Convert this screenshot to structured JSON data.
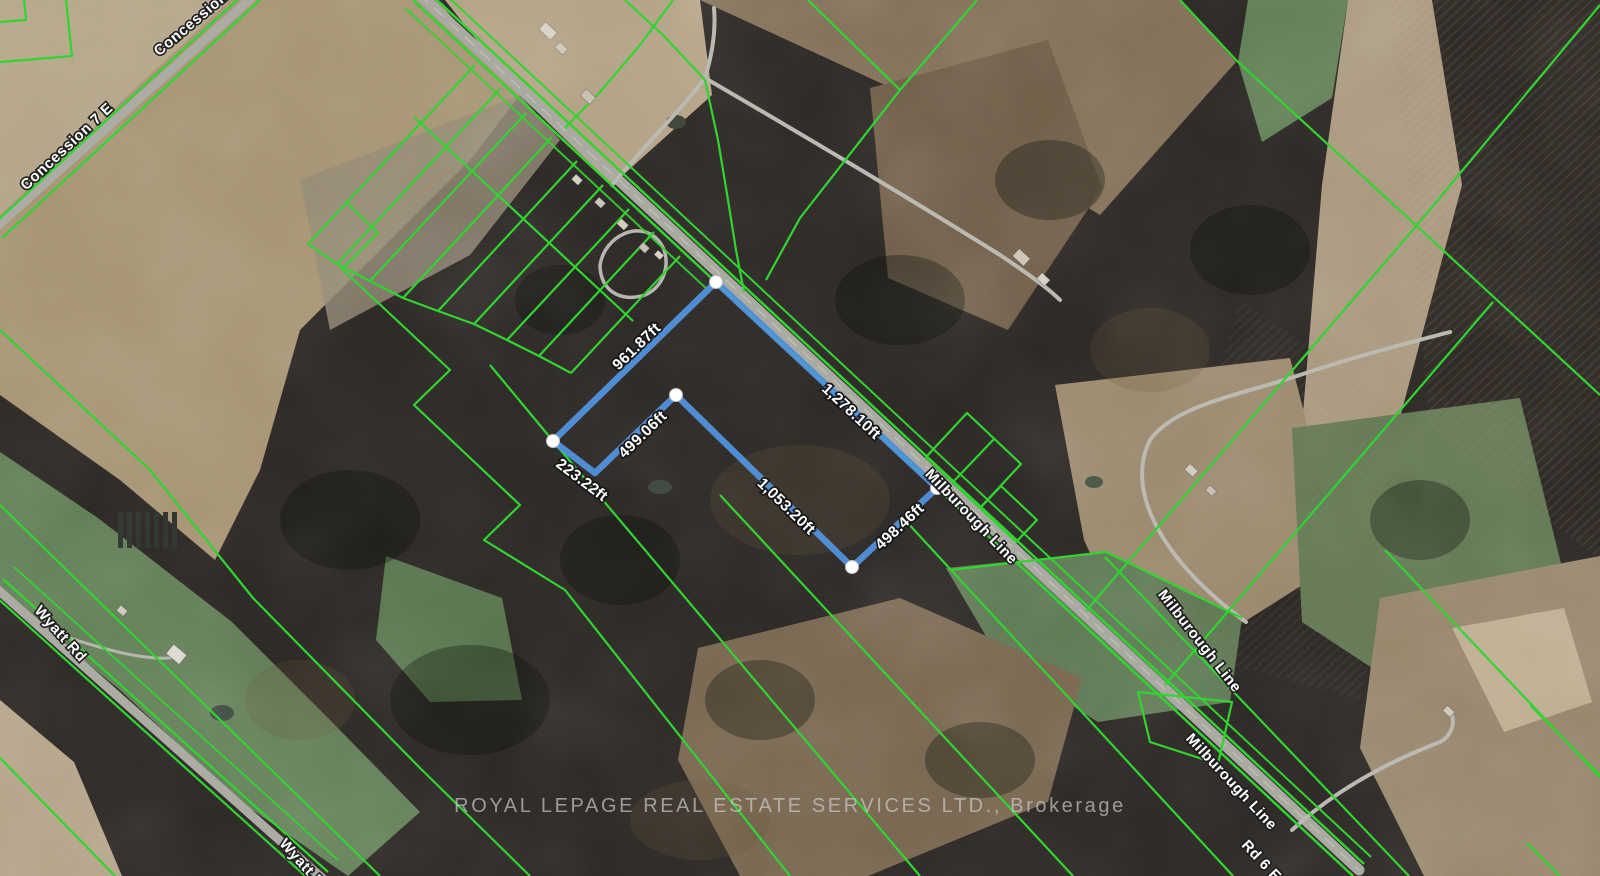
{
  "map_overlay": {
    "watermark": "ROYAL LEPAGE REAL ESTATE SERVICES LTD., Brokerage",
    "road_labels": [
      {
        "id": "concession-7e-1",
        "text": "Concession 7 E"
      },
      {
        "id": "concession-7e-2",
        "text": "Concession 7 E"
      },
      {
        "id": "wyatt-rd-1",
        "text": "Wyatt Rd"
      },
      {
        "id": "wyatt-rd-2",
        "text": "Wyatt Rd"
      },
      {
        "id": "milburough-line-1",
        "text": "Milburough Line"
      },
      {
        "id": "milburough-line-2",
        "text": "Milburough Line"
      },
      {
        "id": "milburough-line-3",
        "text": "Milburough Line"
      },
      {
        "id": "rd-6-e",
        "text": "Rd 6 E"
      }
    ],
    "parcel_edge_labels": [
      {
        "name": "northwest-edge",
        "length": "961.87ft"
      },
      {
        "name": "northeast-road-edge",
        "length": "1,278.10ft"
      },
      {
        "name": "inner-west-edge",
        "length": "499.06ft"
      },
      {
        "name": "west-notch-edge",
        "length": "223.22ft"
      },
      {
        "name": "south-edge",
        "length": "1,053.20ft"
      },
      {
        "name": "southeast-edge",
        "length": "498.46ft"
      }
    ],
    "colors": {
      "parcel_line_green": "#2fd32f",
      "highlight_blue": "#4f90e0",
      "road_gray": "#a7a79f",
      "vertex_white": "#ffffff"
    }
  }
}
